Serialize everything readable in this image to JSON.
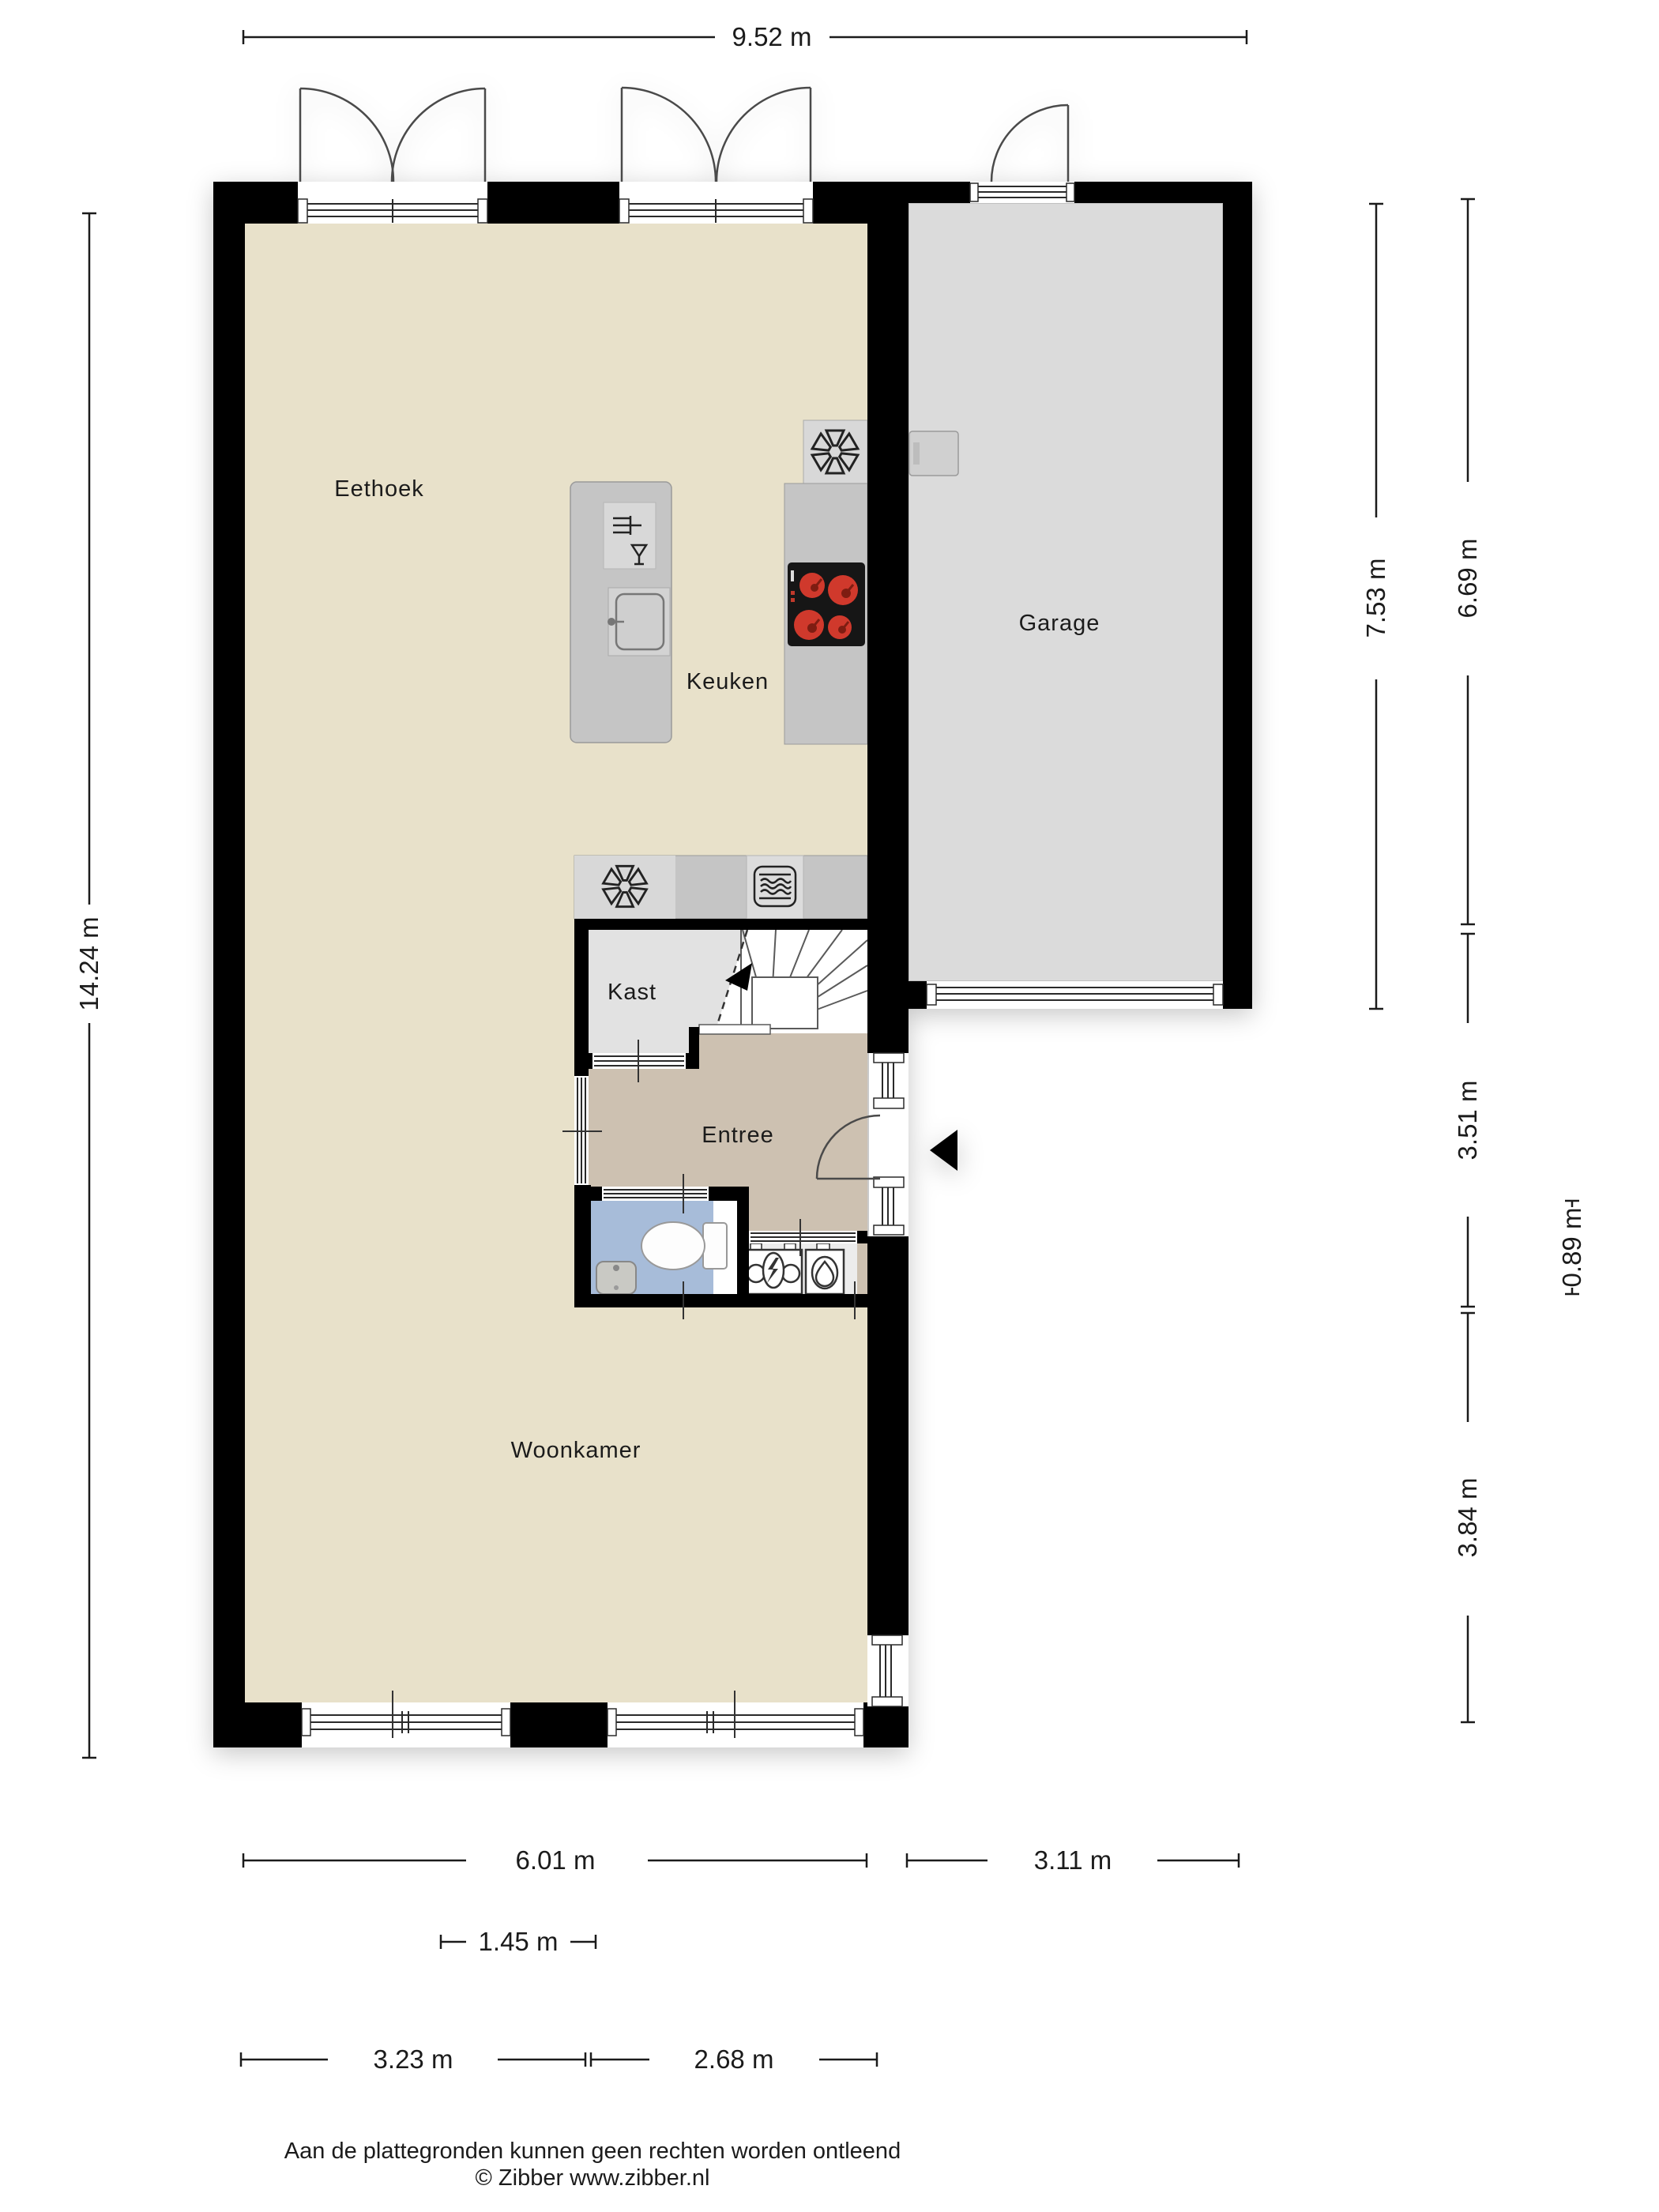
{
  "rooms": {
    "eethoek": "Eethoek",
    "keuken": "Keuken",
    "garage": "Garage",
    "kast": "Kast",
    "entree": "Entree",
    "woonkamer": "Woonkamer"
  },
  "dimensions": {
    "total_width": "9.52 m",
    "total_height": "14.24 m",
    "garage_outer_height": "7.53 m",
    "garage_inner_height": "6.69 m",
    "entree_height": "3.51 m",
    "meter_depth": "0.89 m",
    "woonkamer_right_height": "3.84 m",
    "house_width": "6.01 m",
    "garage_width": "3.11 m",
    "stair_width": "1.45 m",
    "bottom_left_width": "3.23 m",
    "bottom_right_width": "2.68 m"
  },
  "footer": {
    "disclaimer": "Aan de plattegronden kunnen geen rechten worden ontleend",
    "credit": "© Zibber www.zibber.nl"
  },
  "icons": {
    "extractor_fan": "fan-icon",
    "microwave": "microwave-icon",
    "dishwasher": "dishwasher-icon",
    "cooktop": "cooktop-burners-icon",
    "electric_meter": "electric-meter-icon",
    "gas_meter": "gas-meter-icon",
    "entrance_marker": "entrance-arrow-icon"
  },
  "colors": {
    "wall": "#000000",
    "floor_main": "#e8e1ca",
    "floor_garage": "#dbdbdb",
    "floor_entree": "#cdc1b1",
    "floor_toilet": "#a7bcd9",
    "floor_kast": "#e2e2e2",
    "floor_meter": "#ececec",
    "counter": "#c5c5c5",
    "counter_light": "#d8d8d8",
    "cooktop": "#161616",
    "burner_red": "#d0392c"
  }
}
